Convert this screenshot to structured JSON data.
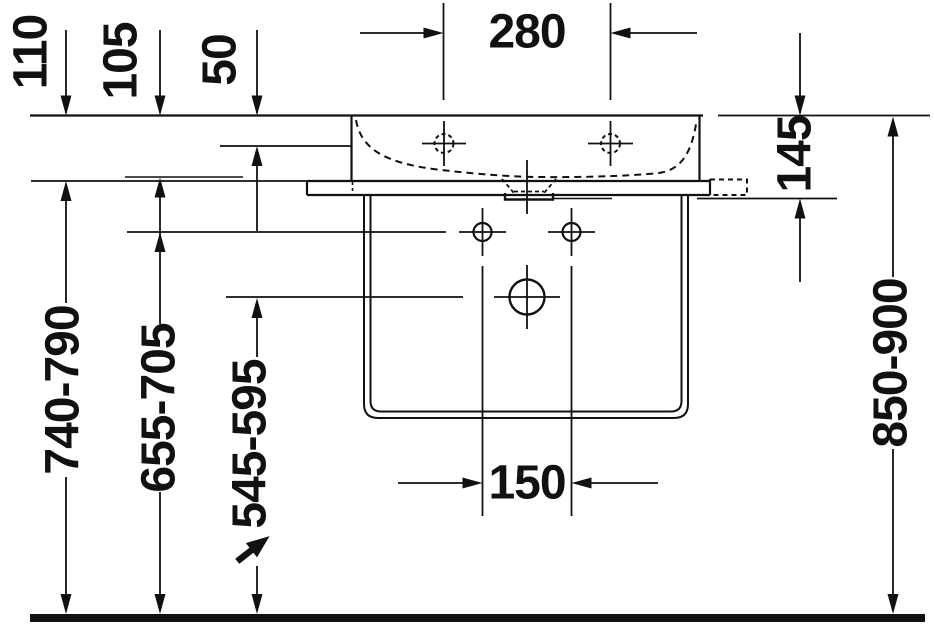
{
  "diagram": {
    "type": "technical-dimension-drawing",
    "subject": "wall-mounted-washbasin-with-console-front-elevation",
    "units": "mm",
    "colors": {
      "line": "#111111",
      "background": "#ffffff"
    },
    "dimensions": {
      "d280": {
        "label": "280",
        "value": 280
      },
      "d110": {
        "label": "110",
        "value": 110
      },
      "d105": {
        "label": "105",
        "value": 105
      },
      "d50": {
        "label": "50",
        "value": 50
      },
      "d145": {
        "label": "145",
        "value": 145
      },
      "d150": {
        "label": "150",
        "value": 150
      },
      "d740_790": {
        "label": "740-790",
        "min": 740,
        "max": 790
      },
      "d655_705": {
        "label": "655-705",
        "min": 655,
        "max": 705
      },
      "d545_595": {
        "label": "545-595",
        "min": 545,
        "max": 595
      },
      "d850_900": {
        "label": "850-900",
        "min": 850,
        "max": 900
      }
    },
    "icons": {
      "height_adjustability": "diagonal-up-right-arrow"
    }
  }
}
